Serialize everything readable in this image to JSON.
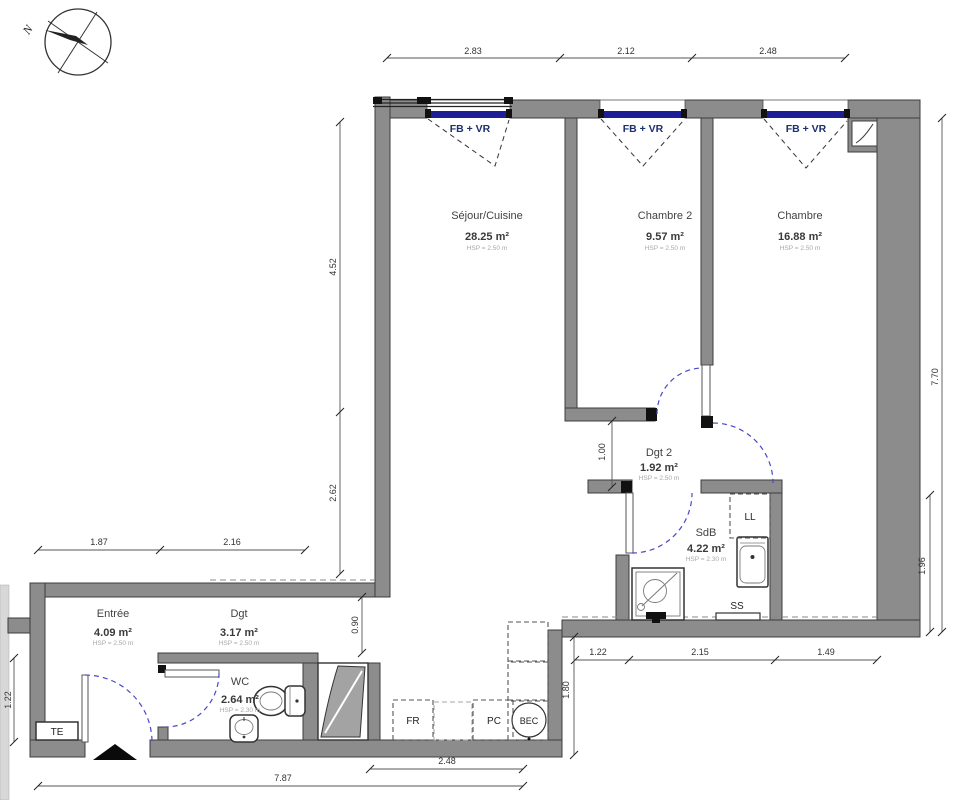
{
  "compass": {
    "north_label": "N"
  },
  "rooms": [
    {
      "name": "Séjour/Cuisine",
      "area": "28.25 m²",
      "hsp": "HSP = 2.50 m"
    },
    {
      "name": "Chambre 2",
      "area": "9.57 m²",
      "hsp": "HSP = 2.50 m"
    },
    {
      "name": "Chambre",
      "area": "16.88 m²",
      "hsp": "HSP = 2.50 m"
    },
    {
      "name": "Dgt 2",
      "area": "1.92 m²",
      "hsp": "HSP = 2.50 m"
    },
    {
      "name": "SdB",
      "area": "4.22 m²",
      "hsp": "HSP = 2.30 m"
    },
    {
      "name": "Entrée",
      "area": "4.09 m²",
      "hsp": "HSP = 2.50 m"
    },
    {
      "name": "Dgt",
      "area": "3.17 m²",
      "hsp": "HSP = 2.50 m"
    },
    {
      "name": "WC",
      "area": "2.64 m²",
      "hsp": "HSP = 2.30 m"
    }
  ],
  "windows": [
    {
      "label": "FB + VR"
    },
    {
      "label": "FB + VR"
    },
    {
      "label": "FB + VR"
    }
  ],
  "equipment": {
    "washing_machine": "LL",
    "towel_dryer": "SS",
    "electrical_board": "TE",
    "fridge": "FR",
    "cooktop": "PC",
    "sink_unit": "BEC"
  },
  "dimensions": {
    "top": [
      "2.83",
      "2.12",
      "2.48"
    ],
    "left_vertical": [
      "4.52",
      "2.62"
    ],
    "entry_horizontal": [
      "1.87",
      "2.16"
    ],
    "entry_left_vertical": "1.22",
    "corridor_width": "0.90",
    "corridor2_height": "1.00",
    "right_vertical": [
      "7.70",
      "1.96"
    ],
    "bottom_inner": [
      "1.22",
      "2.15",
      "1.49"
    ],
    "kitchen_depth": "1.80",
    "bottom_outer": [
      "2.48",
      "7.87"
    ]
  },
  "colors": {
    "wall_fill": "#8c8c8c",
    "window_glass": "#1d1d96",
    "door_swing": "#4848c8",
    "dimension_text": "#333333",
    "hsp_text": "#a8a8a8"
  }
}
